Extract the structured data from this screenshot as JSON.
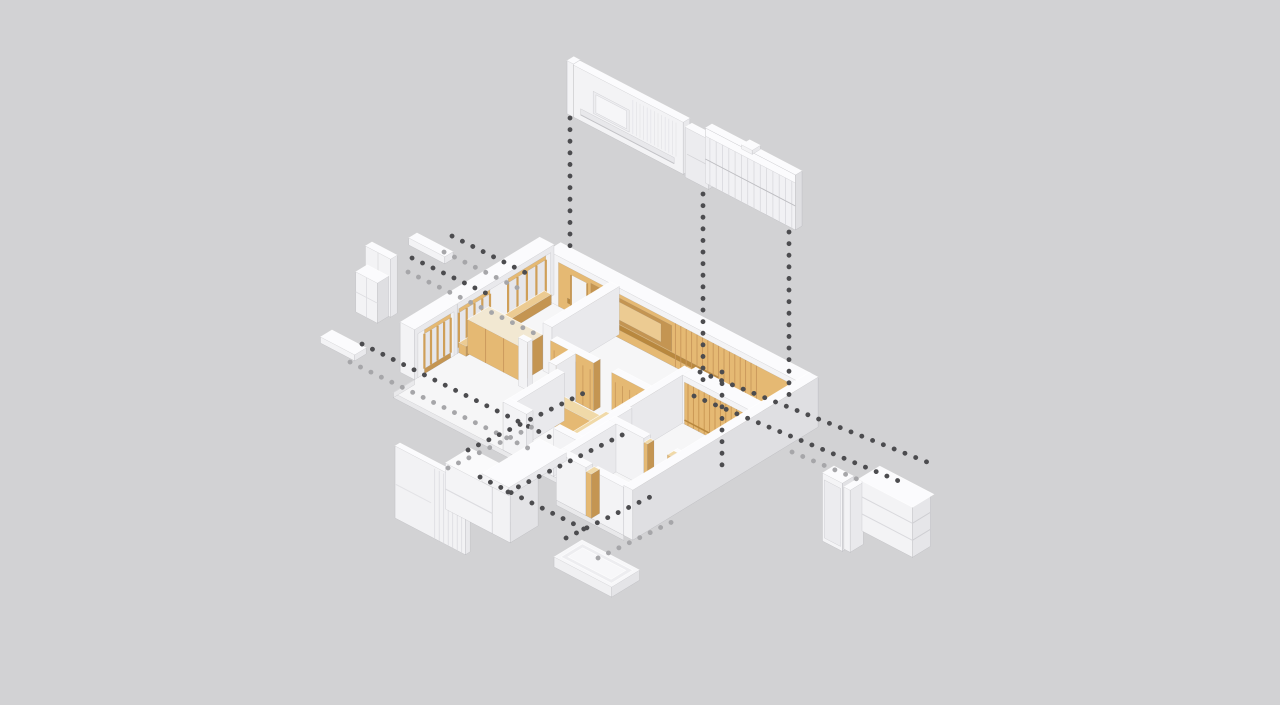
{
  "meta": {
    "type": "architectural-exploded-axonometric",
    "description": "Exploded axonometric diagram of an apartment interior: central floor plan with wood feature walls, exploded white wall panels and furniture connected by dotted leader lines"
  },
  "canvas": {
    "width": 1280,
    "height": 712,
    "background": "#d2d2d4",
    "footer_strip": "#ffffff"
  },
  "palette": {
    "white_top": "#fbfbfd",
    "white_light": "#f3f3f5",
    "white_mid": "#e9e9ec",
    "white_shade": "#dfdfe2",
    "white_dark": "#d6d6d9",
    "glass": "#e6e6ea",
    "floor": "#f6f6f7",
    "floor_edge": "#e9e9eb",
    "wood_top": "#f0d9a8",
    "wood_light": "#e5b973",
    "wood_mid": "#d8ab62",
    "wood_shade": "#c49552",
    "wood_dark": "#b9883e",
    "wood_pale": "#eccb92",
    "dot_dark": "#4c4c4f",
    "dot_light": "#a6a6a9"
  },
  "components": [
    {
      "id": "tv-wall-panel",
      "label": "TV feature wall panel (exploded)"
    },
    {
      "id": "slat-wall-panel",
      "label": "Slatted wall panel (exploded)"
    },
    {
      "id": "wardrobe-cabinet",
      "label": "Wardrobe cabinet (exploded)"
    },
    {
      "id": "wall-shelf",
      "label": "Wall shelf (exploded)"
    },
    {
      "id": "shelf-plank",
      "label": "Shelf plank (exploded)"
    },
    {
      "id": "kitchen-block",
      "label": "Kitchen cabinet block (exploded)"
    },
    {
      "id": "floor-tray",
      "label": "Floor platform tray (exploded)"
    },
    {
      "id": "entry-cabinet",
      "label": "Tall entry cabinet (exploded)"
    },
    {
      "id": "drawer-chest",
      "label": "Drawer chest (exploded)"
    },
    {
      "id": "floor-plan",
      "label": "Apartment floor plan (axonometric)"
    },
    {
      "id": "leader-lines",
      "label": "Dotted leader lines"
    }
  ]
}
